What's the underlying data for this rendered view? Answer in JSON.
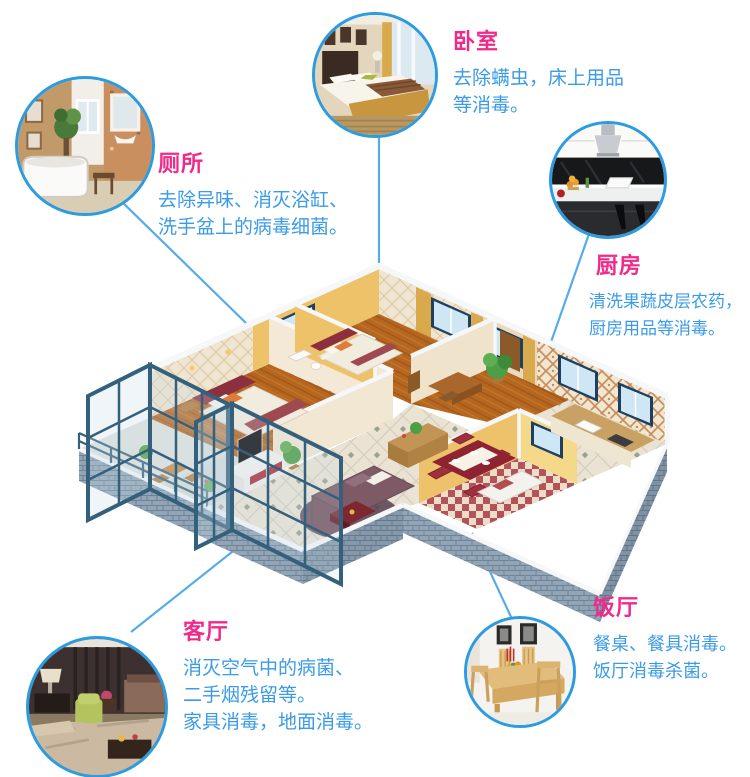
{
  "colors": {
    "title_pink": "#f0298a",
    "desc_blue": "#3b9be8",
    "circle_border": "#2b9ce2",
    "connector_blue": "#57ace8",
    "brick_gray_blue": "#92a5b6",
    "wall_yellow": "#eec268",
    "frame_slate": "#35607c"
  },
  "callouts": [
    {
      "id": "bedroom",
      "title": "卧室",
      "photo": "bedroom-room-photo",
      "lines": [
        "去除螨虫，床上用品",
        "等消毒。"
      ]
    },
    {
      "id": "toilet",
      "title": "厕所",
      "photo": "bathroom-room-photo",
      "lines": [
        "去除异味、消灭浴缸、",
        "洗手盆上的病毒细菌。"
      ]
    },
    {
      "id": "kitchen",
      "title": "厨房",
      "photo": "kitchen-room-photo",
      "lines": [
        "清洗果蔬皮层农药，",
        "厨房用品等消毒。"
      ]
    },
    {
      "id": "living",
      "title": "客厅",
      "photo": "living-room-photo",
      "lines": [
        "消灭空气中的病菌、",
        "二手烟残留等。",
        "家具消毒，地面消毒。"
      ]
    },
    {
      "id": "dining",
      "title": "饭厅",
      "photo": "dining-room-photo",
      "lines": [
        "餐桌、餐具消毒。",
        "饭厅消毒杀菌。"
      ]
    }
  ],
  "floorplan": {
    "kind": "isometric-3d-apartment-cutaway"
  }
}
